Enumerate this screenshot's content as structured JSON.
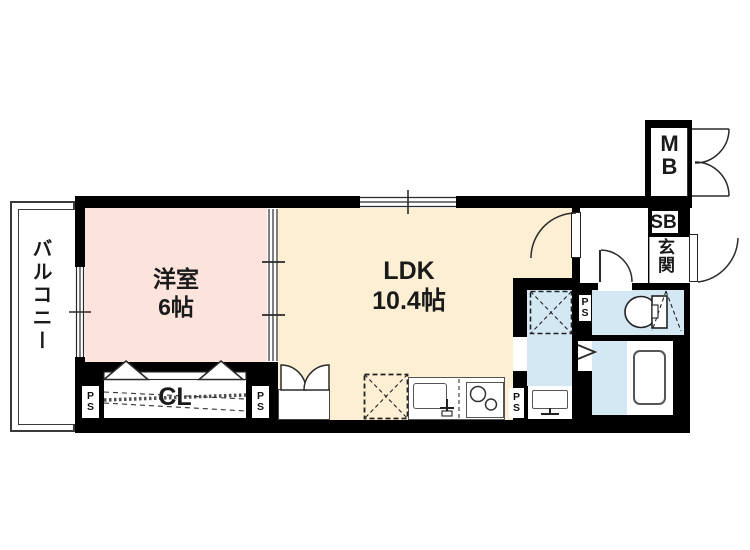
{
  "floorplan": {
    "balcony_label": "バルコニー",
    "western_room": {
      "line1": "洋室",
      "line2": "6帖"
    },
    "ldk": {
      "line1": "LDK",
      "line2": "10.4帖"
    },
    "closet_label": "CL",
    "ps": {
      "line1": "P",
      "line2": "S"
    },
    "meter_box": {
      "line1": "M",
      "line2": "B"
    },
    "shoe_box_label": "SB",
    "entrance_label": "玄関",
    "colors": {
      "wall": "#000000",
      "western_room_fill": "#fce4dd",
      "ldk_fill": "#fcefd4",
      "wet_area_fill": "#d4e8f4",
      "line": "#2a2a2a"
    }
  }
}
